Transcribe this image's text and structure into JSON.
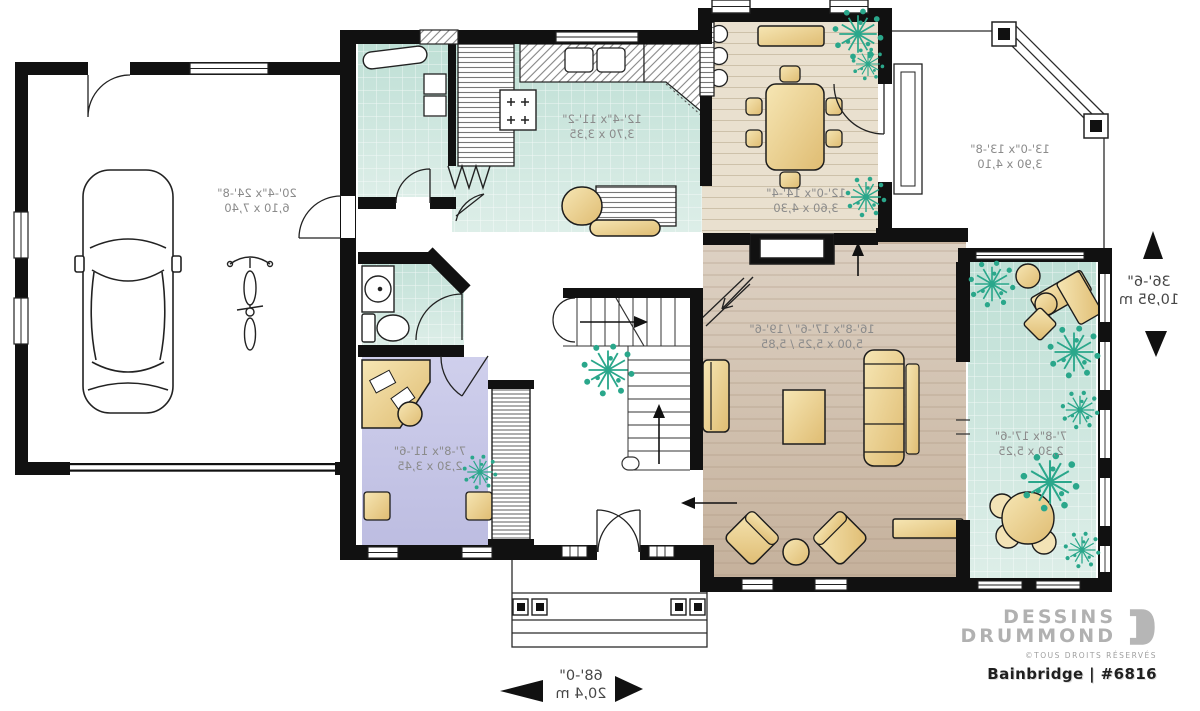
{
  "meta": {
    "brand_line1": "DESSINS",
    "brand_line2": "DRUMMOND",
    "rights": "©TOUS DROITS RÉSERVÉS",
    "plan_title": "Bainbridge | #6816"
  },
  "rooms": {
    "garage": {
      "imperial": "20'-4\"x 24'-8\"",
      "metric": "6,10 x 7,40"
    },
    "kitchen": {
      "imperial": "12'-4\"x 11'-2\"",
      "metric": "3,70 x 3,35"
    },
    "dining": {
      "imperial": "12'-0\"x 14'-4\"",
      "metric": "3,60 x 4,30"
    },
    "deck": {
      "imperial": "13'-0\"x 13'-8\"",
      "metric": "3,90 x 4,10"
    },
    "living": {
      "imperial": "16'-8\"x 17'-6\" / 19'-6\"",
      "metric": "5,00 x 5,25 / 5,85"
    },
    "office": {
      "imperial": "7'-8\"x 11'-6\"",
      "metric": "2,30 x 3,45"
    },
    "sunroom": {
      "imperial": "7'-8\"x 17'-6\"",
      "metric": "2,30 x 5,25"
    }
  },
  "dimensions": {
    "overall_width": {
      "imperial": "68'-0\"",
      "metric": "20,4 m"
    },
    "overall_depth": {
      "imperial": "36'-6\"",
      "metric": "10,95 m"
    }
  },
  "colors": {
    "wall": "#111111",
    "tile_teal": "#cfe8e0",
    "wood_light": "#e9e0cf",
    "wood_dark": "#c9b6a2",
    "office_lavender": "#c9c9e7",
    "furniture_tan": "#eccf96",
    "plant_green": "#2aa78b",
    "label_gray": "#8b8b8b"
  }
}
